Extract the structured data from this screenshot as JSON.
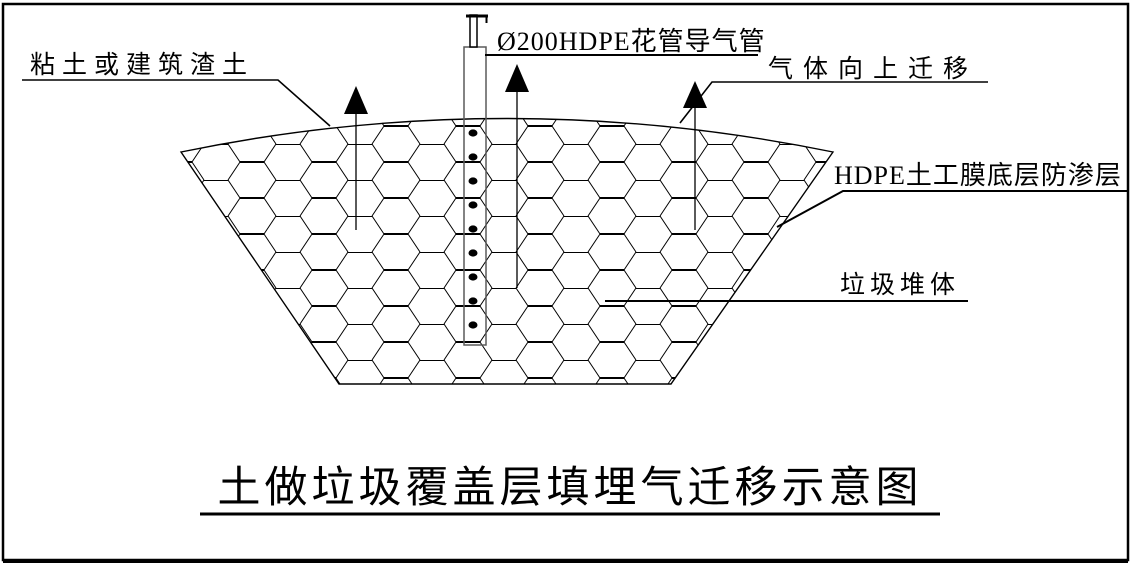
{
  "canvas": {
    "background": "#ffffff",
    "line_color": "#000000",
    "pipe_line_color": "#5a5a5a"
  },
  "title": "土做垃圾覆盖层填埋气迁移示意图",
  "labels": {
    "cover_soil": "粘土或建筑渣土",
    "gas_pipe": "Ø200HDPE花管导气管",
    "gas_upward": "气体向上迁移",
    "hdpe_liner": "HDPE土工膜底层防渗层",
    "waste_body": "垃圾堆体"
  },
  "figure": {
    "pattern": "hexagon-honeycomb",
    "up_arrow_count": 3,
    "perforations": {
      "count": 9,
      "cx": 473,
      "y_start": 133,
      "y_step": 24,
      "rx": 4.5,
      "ry": 3.6
    }
  }
}
